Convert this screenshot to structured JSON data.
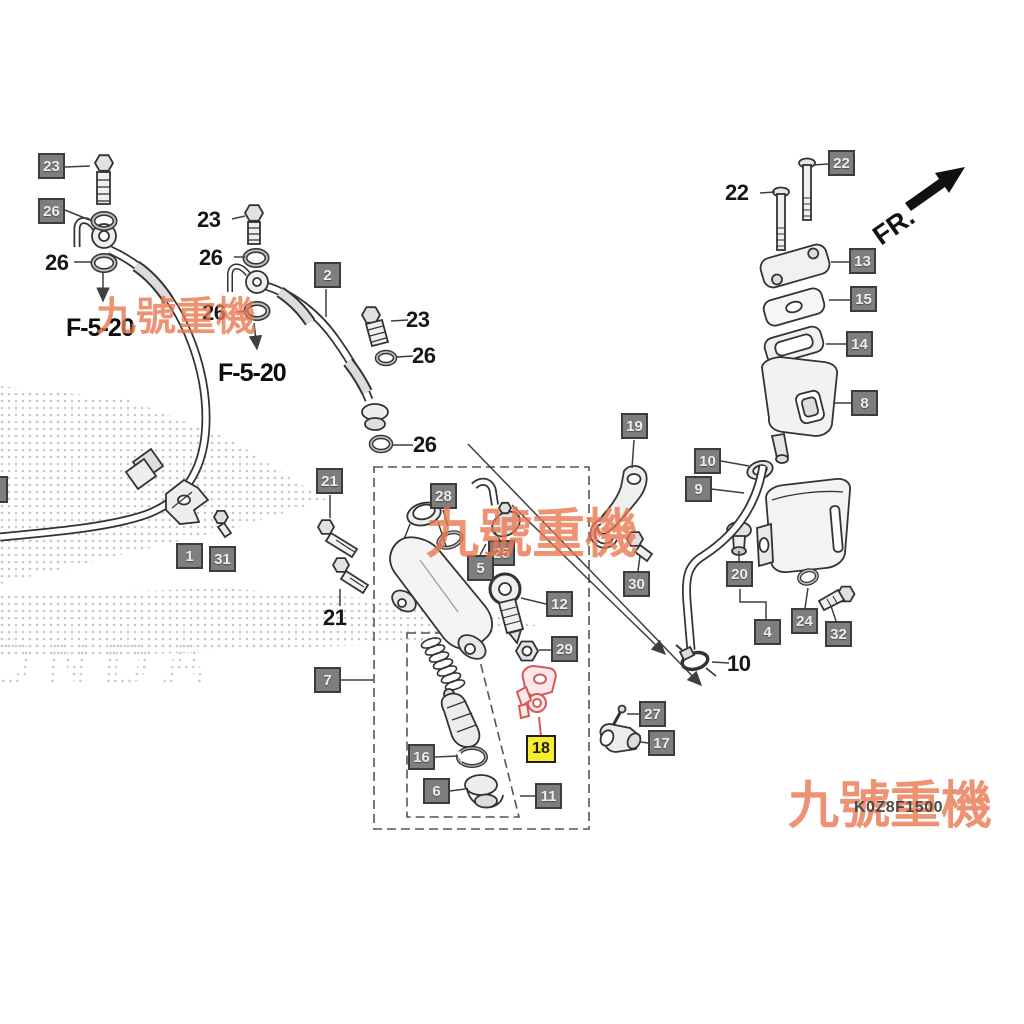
{
  "diagram": {
    "part_code": "K0Z8F1500",
    "direction_indicator": "FR.",
    "brand_watermark": "HONDA",
    "seller_watermark": "九號重機",
    "highlighted_part_label": "18",
    "colors": {
      "label_box_bg": "#7e7e7e",
      "label_box_border": "#3c3c3c",
      "highlight_bg": "#f6ee2d",
      "highlight_part": "#d85858",
      "watermark": "#e97850",
      "line": "#333333"
    }
  },
  "boxed_labels": [
    {
      "text": "23",
      "x": 38,
      "y": 153
    },
    {
      "text": "26",
      "x": 38,
      "y": 198
    },
    {
      "text": "2",
      "x": 314,
      "y": 262
    },
    {
      "text": "21",
      "x": 316,
      "y": 468
    },
    {
      "text": "28",
      "x": 430,
      "y": 483
    },
    {
      "text": "25",
      "x": 488,
      "y": 540
    },
    {
      "text": "5",
      "x": 467,
      "y": 555
    },
    {
      "text": "12",
      "x": 546,
      "y": 591
    },
    {
      "text": "29",
      "x": 551,
      "y": 636
    },
    {
      "text": "7",
      "x": 314,
      "y": 667
    },
    {
      "text": "16",
      "x": 408,
      "y": 744
    },
    {
      "text": "6",
      "x": 423,
      "y": 778
    },
    {
      "text": "11",
      "x": 535,
      "y": 783
    },
    {
      "text": "18",
      "x": 526,
      "y": 735,
      "highlight": true
    },
    {
      "text": "27",
      "x": 639,
      "y": 701
    },
    {
      "text": "17",
      "x": 648,
      "y": 730
    },
    {
      "text": "19",
      "x": 621,
      "y": 413
    },
    {
      "text": "10",
      "x": 694,
      "y": 448
    },
    {
      "text": "9",
      "x": 685,
      "y": 476
    },
    {
      "text": "30",
      "x": 623,
      "y": 571
    },
    {
      "text": "20",
      "x": 726,
      "y": 561
    },
    {
      "text": "4",
      "x": 754,
      "y": 619
    },
    {
      "text": "24",
      "x": 791,
      "y": 608
    },
    {
      "text": "32",
      "x": 825,
      "y": 621
    },
    {
      "text": "22",
      "x": 828,
      "y": 150
    },
    {
      "text": "13",
      "x": 849,
      "y": 248
    },
    {
      "text": "15",
      "x": 850,
      "y": 286
    },
    {
      "text": "14",
      "x": 846,
      "y": 331
    },
    {
      "text": "8",
      "x": 851,
      "y": 390
    },
    {
      "text": "1",
      "x": 176,
      "y": 543
    },
    {
      "text": "31",
      "x": 209,
      "y": 546
    },
    {
      "text": "",
      "x": -18,
      "y": 476,
      "cropped": true
    }
  ],
  "plain_labels": [
    {
      "text": "26",
      "x": 45,
      "y": 250,
      "kind": "num"
    },
    {
      "text": "23",
      "x": 197,
      "y": 207,
      "kind": "num"
    },
    {
      "text": "26",
      "x": 199,
      "y": 245,
      "kind": "num"
    },
    {
      "text": "26",
      "x": 202,
      "y": 300,
      "kind": "num"
    },
    {
      "text": "F-5-20",
      "x": 66,
      "y": 314,
      "kind": "ref"
    },
    {
      "text": "F-5-20",
      "x": 218,
      "y": 359,
      "kind": "ref"
    },
    {
      "text": "23",
      "x": 406,
      "y": 307,
      "kind": "num"
    },
    {
      "text": "26",
      "x": 412,
      "y": 343,
      "kind": "num"
    },
    {
      "text": "26",
      "x": 413,
      "y": 432,
      "kind": "num"
    },
    {
      "text": "21",
      "x": 323,
      "y": 605,
      "kind": "num"
    },
    {
      "text": "22",
      "x": 725,
      "y": 180,
      "kind": "num"
    },
    {
      "text": "10",
      "x": 727,
      "y": 651,
      "kind": "num"
    }
  ],
  "watermarks": [
    {
      "text": "九號重機",
      "x": 96,
      "y": 297,
      "size": 40
    },
    {
      "text": "九號重機",
      "x": 426,
      "y": 508,
      "size": 53
    },
    {
      "text": "九號重機",
      "x": 788,
      "y": 781,
      "size": 51
    }
  ]
}
